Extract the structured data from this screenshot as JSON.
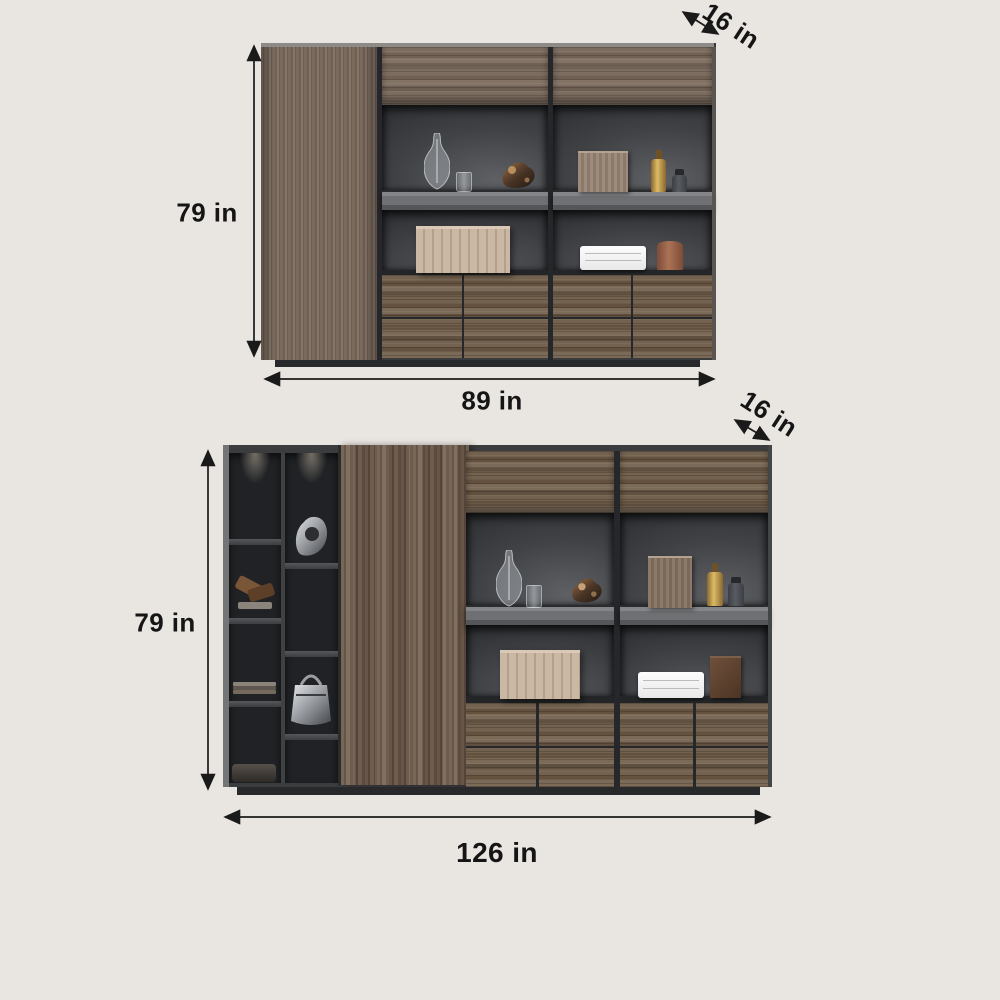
{
  "background_color": "#e9e5e0",
  "top_cabinet": {
    "height_label": "79 in",
    "width_label": "89 in",
    "depth_label": "16 in"
  },
  "bottom_cabinet": {
    "height_label": "79 in",
    "width_label": "126 in",
    "depth_label": "16 in"
  },
  "colors": {
    "dimension_text": "#151515",
    "arrow": "#1a1a1a",
    "frame_dark": "#3a3b3d",
    "wood_light": "#7b6c5f",
    "wood_dark": "#6a594b",
    "shelf_gray": "#737578",
    "plinth": "#28292b",
    "accent_gold": "#c19a4f",
    "accent_terracotta": "#9a6750",
    "accent_beige_box": "#c3b19d"
  }
}
